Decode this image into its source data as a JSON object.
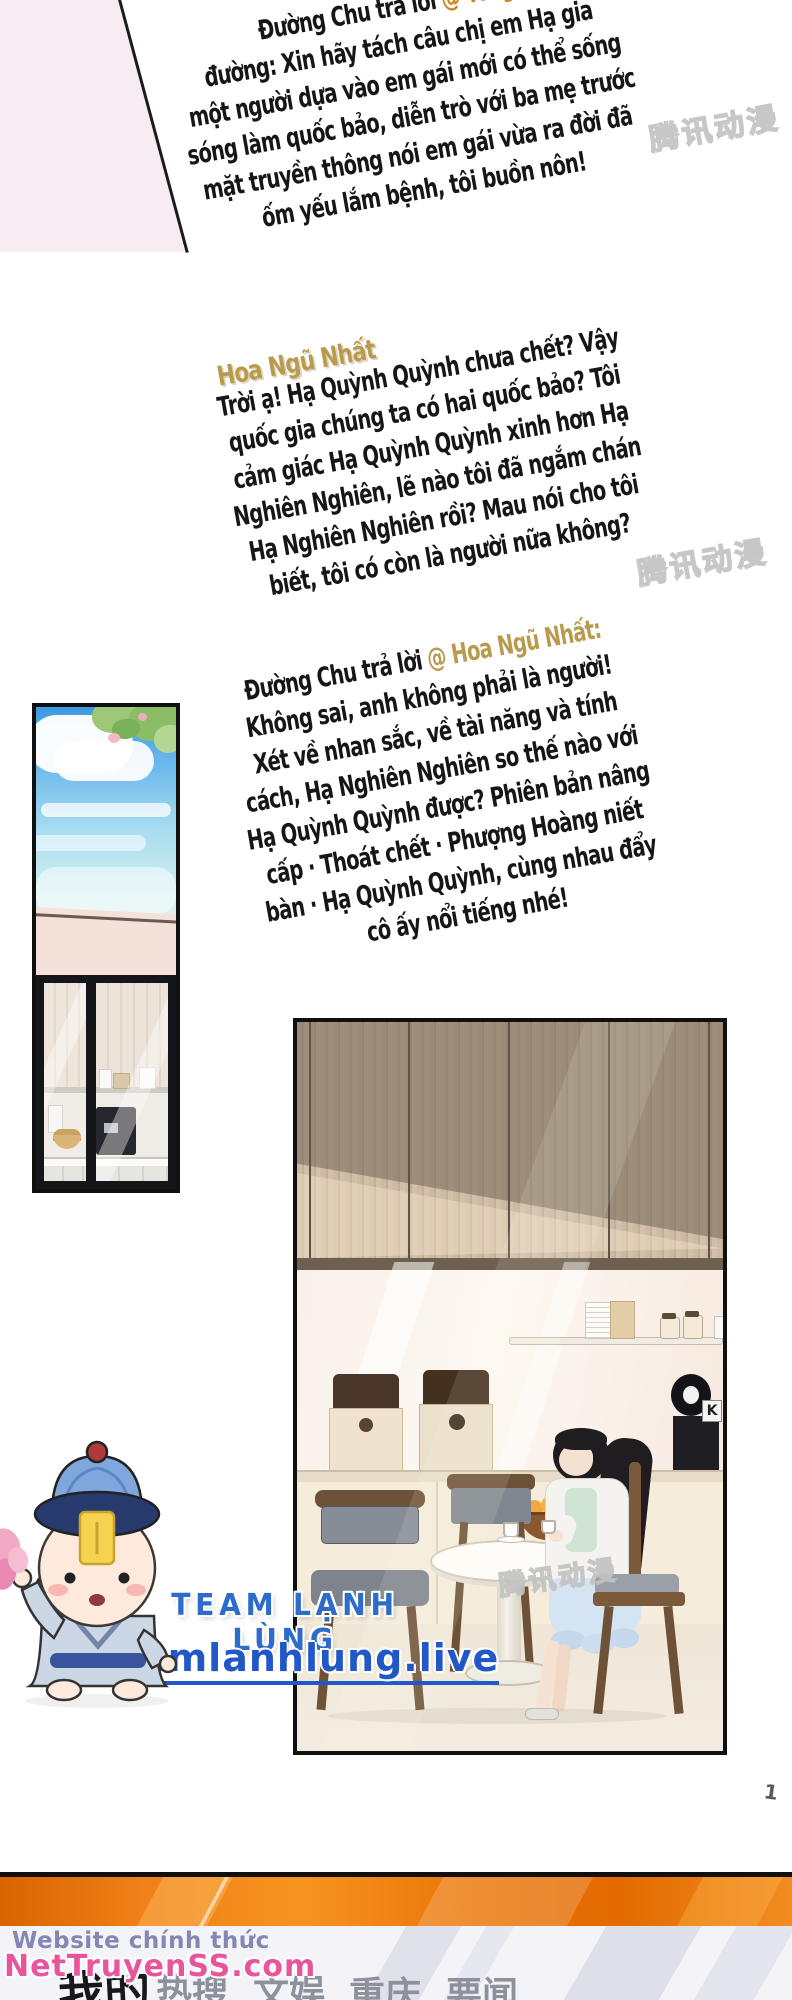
{
  "comments": {
    "reply1": {
      "prefix": "Đường Chu trả lời",
      "mention": "@ Tôi gà",
      "lines": [
        "đường: Xin hãy tách câu chị em Hạ gia",
        "một người dựa vào em gái mới có thể sống",
        "sóng làm quốc bảo, diễn trò với ba mẹ trước",
        "mặt truyền thông nói em gái vừa ra đời đã",
        "ốm yếu lắm bệnh, tôi buồn nôn!"
      ]
    },
    "user2": "Hoa Ngũ Nhất",
    "comment2": {
      "lines": [
        "Trời ạ! Hạ Quỳnh Quỳnh chưa chết? Vậy",
        "quốc gia chúng ta có hai quốc bảo? Tôi",
        "cảm giác Hạ Quỳnh Quỳnh xinh hơn Hạ",
        "Nghiên Nghiên, lẽ nào tôi đã ngắm chán",
        "Hạ Nghiên Nghiên rồi? Mau nói cho tôi",
        "biết, tôi có còn là người nữa không?"
      ]
    },
    "reply2": {
      "prefix": "Đường Chu trả lời",
      "mention": "@ Hoa Ngũ Nhất:",
      "lines": [
        "Không sai, anh không phải là người!",
        "Xét về nhan sắc, về tài năng và tính",
        "cách, Hạ Nghiên Nghiên so thế nào với",
        "Hạ Quỳnh Quỳnh được? Phiên bản nâng",
        "cấp · Thoát chết · Phượng Hoàng niết",
        "bàn · Hạ Quỳnh Quỳnh, cùng nhau đẩy",
        "cô ấy nổi tiếng nhé!"
      ]
    }
  },
  "team": {
    "name": "TEAM LẠNH LÙNG",
    "url": "teamlanhlung.live"
  },
  "watermarks": {
    "tencent": "腾讯动漫",
    "site_line1": "Website chính thức",
    "site_line2": "NetTruyenSS.com"
  },
  "tabs": [
    {
      "label": "我的",
      "active": true
    },
    {
      "label": "热搜",
      "active": false
    },
    {
      "label": "文娱",
      "active": false
    },
    {
      "label": "重庆",
      "active": false
    },
    {
      "label": "要闻",
      "active": false
    }
  ],
  "panel_art": {
    "coffee_maker_label": "K"
  },
  "stray_mark": "1",
  "colors": {
    "mention_orange": "#d0861f",
    "username_gold": "#b99b4e",
    "team_blue": "#2e6ccc",
    "url_blue": "#2257c8",
    "bar_orange": "#ef7d10",
    "site_pink": "#e8559c"
  }
}
